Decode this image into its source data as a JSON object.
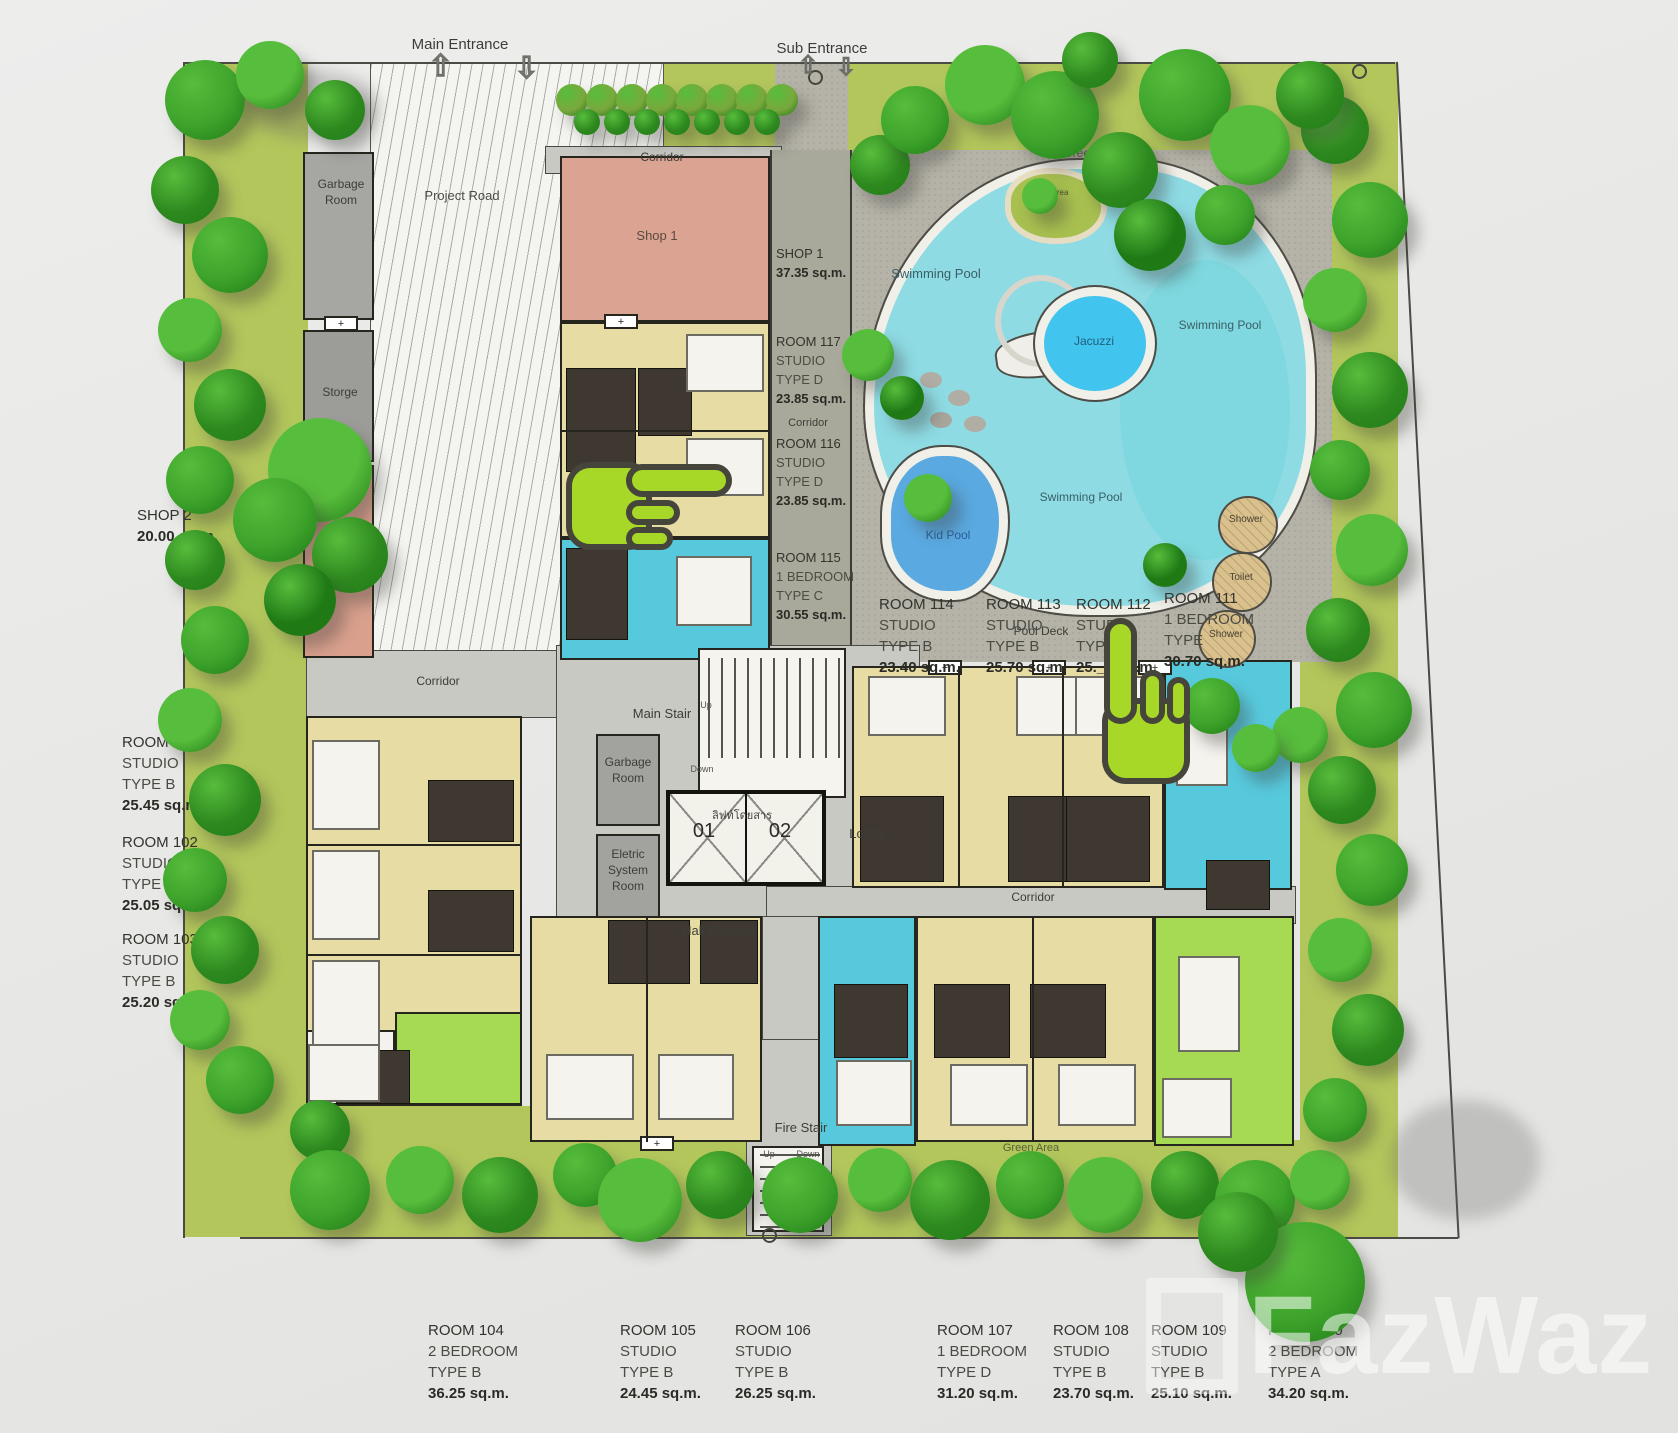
{
  "site": {
    "main_entrance": "Main Entrance",
    "sub_entrance": "Sub Entrance",
    "project_road": "Project Road",
    "corridor": "Corridor",
    "green_area": "Green Area",
    "door_symbol": "+",
    "arrow_up": "⇧",
    "arrow_down": "⇩",
    "watermark": "FazWaz"
  },
  "pool": {
    "swimming_pool": "Swimming Pool",
    "jacuzzi": "Jacuzzi",
    "kid_pool": "Kid Pool",
    "pool_deck": "Pool Deck",
    "shower": "Shower",
    "toilet": "Toilet"
  },
  "core": {
    "main_stair": "Main Stair",
    "fire_stair": "Fire Stair",
    "hall_elevator": "Hall Elevator",
    "lobby": "Lobby",
    "garbage_room": "Garbage Room",
    "storage_room": "Storge",
    "electric_room": "Eletric System Room",
    "elevator_thai": "ลิฟท์โดยสาร",
    "elevator_left": "01",
    "elevator_right": "02",
    "up": "Up",
    "down": "Down"
  },
  "shops": {
    "shop1_room": "Shop 1",
    "shop2_room": "Shop 2",
    "shop1_info": {
      "name": "SHOP 1",
      "area": "37.35 sq.m."
    },
    "shop2_info": {
      "name": "SHOP 2",
      "area": "20.00 sq.m."
    }
  },
  "rooms": {
    "r101": {
      "name": "ROOM 101",
      "kind": "STUDIO",
      "type": "TYPE B",
      "area": "25.45 sq.m."
    },
    "r102": {
      "name": "ROOM 102",
      "kind": "STUDIO",
      "type": "TYPE B",
      "area": "25.05 sq.m."
    },
    "r103": {
      "name": "ROOM 103",
      "kind": "STUDIO",
      "type": "TYPE B",
      "area": "25.20 sq.m."
    },
    "r104": {
      "name": "ROOM 104",
      "kind": "2 BEDROOM",
      "type": "TYPE B",
      "area": "36.25 sq.m."
    },
    "r105": {
      "name": "ROOM 105",
      "kind": "STUDIO",
      "type": "TYPE B",
      "area": "24.45 sq.m."
    },
    "r106": {
      "name": "ROOM 106",
      "kind": "STUDIO",
      "type": "TYPE B",
      "area": "26.25 sq.m."
    },
    "r107": {
      "name": "ROOM 107",
      "kind": "1 BEDROOM",
      "type": "TYPE D",
      "area": "31.20 sq.m."
    },
    "r108": {
      "name": "ROOM 108",
      "kind": "STUDIO",
      "type": "TYPE B",
      "area": "23.70 sq.m."
    },
    "r109": {
      "name": "ROOM 109",
      "kind": "STUDIO",
      "type": "TYPE B",
      "area": "25.10 sq.m."
    },
    "r110": {
      "name": "ROOM 110",
      "kind": "2 BEDROOM",
      "type": "TYPE A",
      "area": "34.20 sq.m."
    },
    "r111": {
      "name": "ROOM 111",
      "kind": "1 BEDROOM",
      "type": "TYPE",
      "area": "30.70 sq.m."
    },
    "r112": {
      "name": "ROOM 112",
      "kind": "STUDIO",
      "type": "TYPE",
      "area": "25.__ sq.m."
    },
    "r113": {
      "name": "ROOM 113",
      "kind": "STUDIO",
      "type": "TYPE B",
      "area": "25.70 sq.m."
    },
    "r114": {
      "name": "ROOM 114",
      "kind": "STUDIO",
      "type": "TYPE B",
      "area": "23.40 sq.m."
    },
    "r115": {
      "name": "ROOM 115",
      "kind": "1 BEDROOM",
      "type": "TYPE C",
      "area": "30.55 sq.m."
    },
    "r116": {
      "name": "ROOM 116",
      "kind": "STUDIO",
      "type": "TYPE D",
      "area": "23.85 sq.m."
    },
    "r117": {
      "name": "ROOM 117",
      "kind": "STUDIO",
      "type": "TYPE D",
      "area": "23.85 sq.m."
    }
  },
  "colors": {
    "grass": "#b3c65c",
    "pool_water": "#8edbe4",
    "kid_pool": "#5aa9e0",
    "jacuzzi": "#41c4ee",
    "studio_unit": "#e6dca4",
    "one_bed_unit": "#57c9dd",
    "two_bed_unit": "#a6da52",
    "shop": "#dba392",
    "hand_cursor": "#a8d827"
  }
}
